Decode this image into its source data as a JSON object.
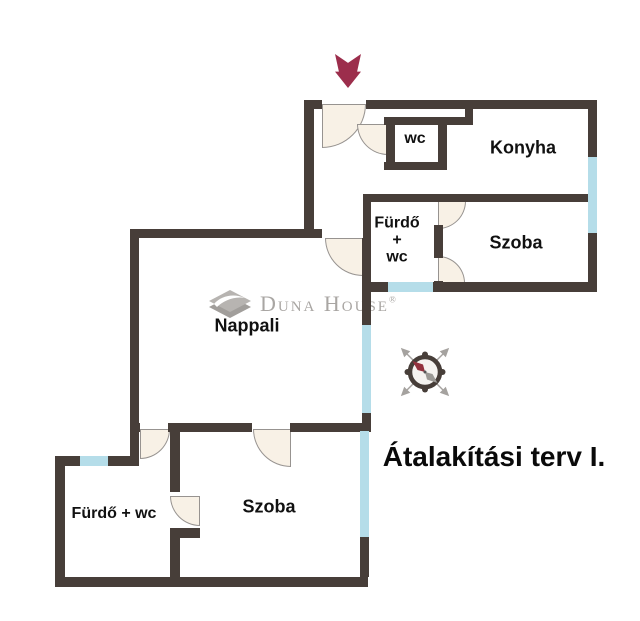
{
  "title": "Átalakítási terv I.",
  "watermark": {
    "brand": "Duna House",
    "registered": "®"
  },
  "rooms": {
    "wc_upper": {
      "label": "wc"
    },
    "konyha": {
      "label": "Konyha"
    },
    "furdo_upper": {
      "lines": [
        "Fürdő",
        "+",
        "wc"
      ]
    },
    "szoba_upper": {
      "label": "Szoba"
    },
    "nappali": {
      "label": "Nappali"
    },
    "furdo_lower": {
      "label": "Fürdő + wc"
    },
    "szoba_lower": {
      "label": "Szoba"
    }
  },
  "icons": {
    "entrance_arrow": "entrance-direction-arrow",
    "compass": "compass-rose",
    "watermark_logo": "duna-house-diamond"
  },
  "colors": {
    "wall": "#473e39",
    "window": "#b5dde9",
    "door_fill": "#f8f1e6",
    "door_edge": "#979390",
    "arrow": "#9c2e4c",
    "text": "#111111",
    "watermark": "#a9a6a3",
    "needle_red": "#93323e",
    "needle_gray": "#9b9995"
  }
}
